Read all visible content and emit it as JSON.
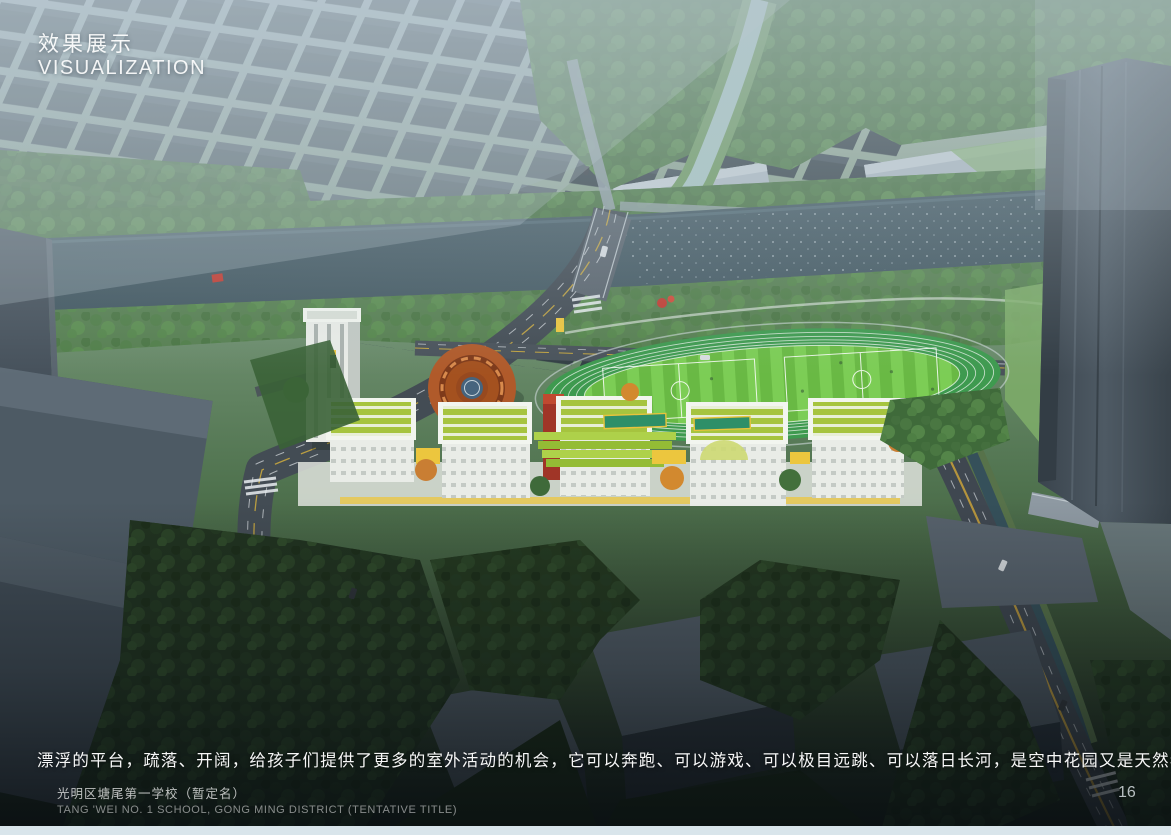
{
  "slide": {
    "title_cn": "效果展示",
    "title_en": "VISUALIZATION",
    "caption": "漂浮的平台，疏落、开阔，给孩子们提供了更多的室外活动的机会，它可以奔跑、可以游戏、可以极目远跳、可以落日长河，是空中花园又是天然看台，城市、景观，尽收眼底。",
    "project_name_cn": "光明区塘尾第一学校（暂定名）",
    "project_name_en": "TANG 'WEI NO. 1 SCHOOL, GONG MING DISTRICT (TENTATIVE TITLE)",
    "page_number": "16"
  },
  "scene": {
    "type": "aerial-architectural-rendering",
    "subject": "school campus with rooftop gardens, circular terracotta courtyard building, green running track and striped soccer field beside a river"
  },
  "colors": {
    "haze": "#b9c8d2",
    "water": "#425962",
    "canal": "#a8c6c2",
    "track_green": "#3e9a4f",
    "roof_lime": "#a6c43f",
    "terracotta": "#b05a2a",
    "terracotta_dark": "#7e3a1a",
    "helipad_blue": "#46647e",
    "building_white": "#e9ece7",
    "accent_yellow": "#ecc63e",
    "accent_red": "#b03527",
    "road": "#454e56",
    "tower_gray": "#4a5560",
    "tree_green": "#4a7443",
    "tree_dark": "#223620",
    "footer_strip": "#d9e5eb"
  }
}
